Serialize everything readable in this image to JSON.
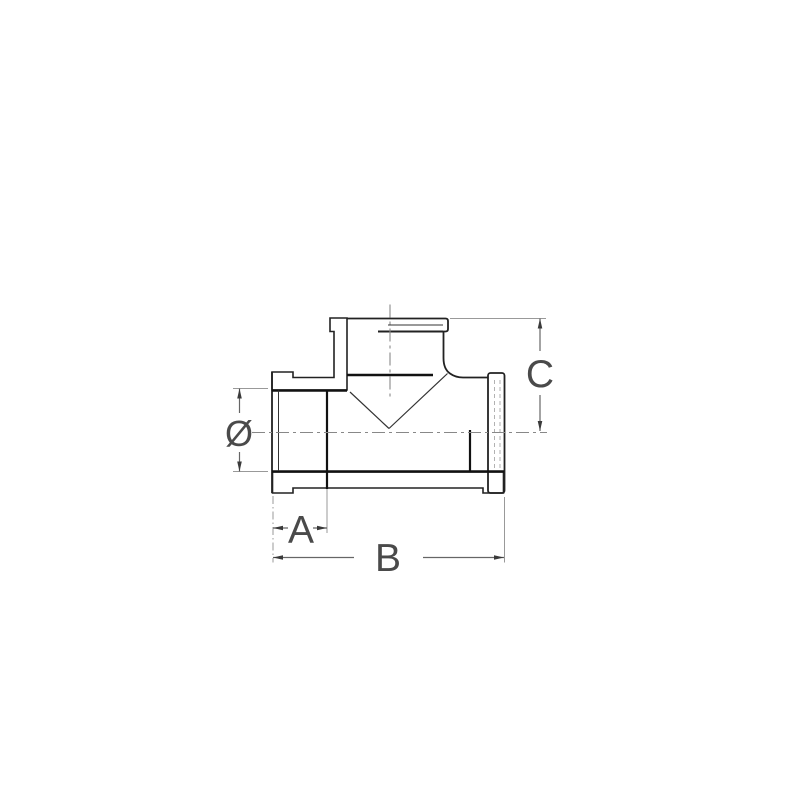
{
  "page": {
    "background": "#ffffff"
  },
  "drawing": {
    "kind": "technical-section-drawing",
    "subject": "threaded-pipe-tee-fitting",
    "dimension_labels": {
      "diameter": "Ø",
      "a": "A",
      "b": "B",
      "c": "C"
    },
    "colors": {
      "outline": "#222222",
      "bold_edge": "#111111",
      "dimension_line": "#666666",
      "extension_line": "#999999",
      "centerline": "#888888",
      "label": "#4a4a4a",
      "background": "#ffffff"
    }
  }
}
